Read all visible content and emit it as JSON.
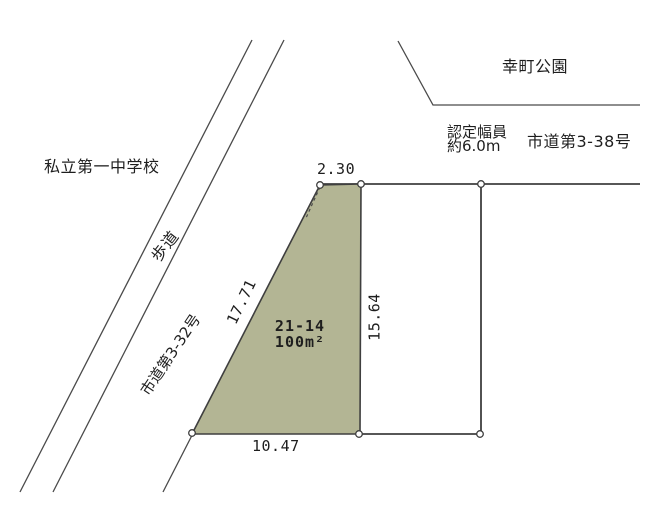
{
  "labels": {
    "school": "私立第一中学校",
    "park": "幸町公園",
    "sidewalk": "歩道",
    "road_west_name": "市道第3-32号",
    "road_north_name": "市道第3-38号",
    "road_width_line1": "認定幅員",
    "road_width_line2": "約6.0m",
    "parcel_number": "21-14",
    "parcel_area": "100m²"
  },
  "dimensions": {
    "top_m": "2.30",
    "left_m": "17.71",
    "right_m": "15.64",
    "bottom_m": "10.47"
  },
  "colors": {
    "parcel_fill": "#b3b594",
    "line": "#4a4a4a",
    "text": "#1e1e1e",
    "background": "#ffffff"
  }
}
